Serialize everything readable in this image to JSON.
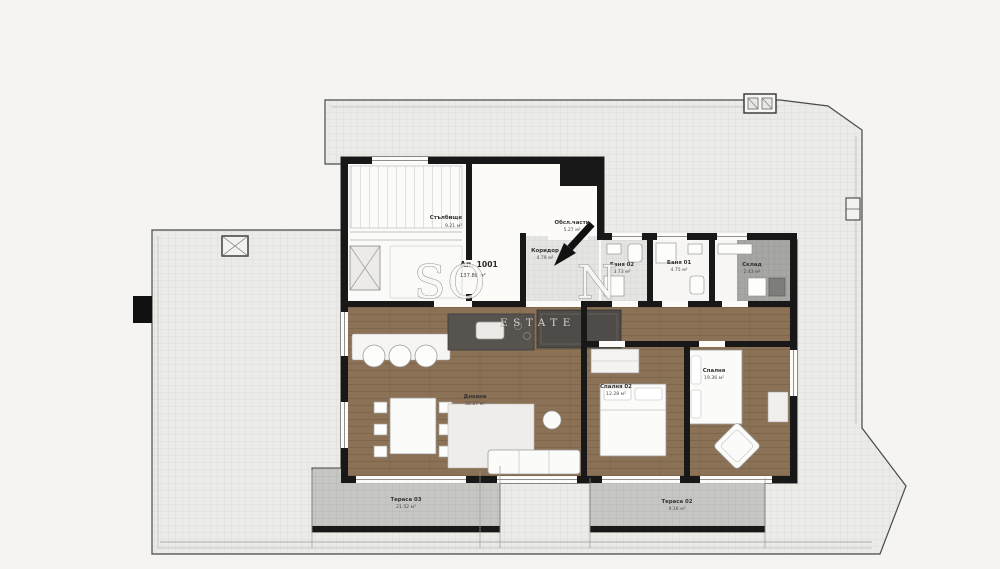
{
  "watermark": {
    "left_letters": "SO",
    "right_letter": "N",
    "line2": "ESTATE"
  },
  "apartment": {
    "number": "Ап. 1001",
    "area": "137.88 м²"
  },
  "rooms": [
    {
      "id": "stairs",
      "label": "Стълбище",
      "area": "9.21 м²"
    },
    {
      "id": "service",
      "label": "Обсл.части",
      "area": "5.27 м²"
    },
    {
      "id": "corridor",
      "label": "Коридор",
      "area": "4.79 м²"
    },
    {
      "id": "bath-02",
      "label": "Баня 02",
      "area": "3.73 м²"
    },
    {
      "id": "bath-01",
      "label": "Баня 01",
      "area": "4.75 м²"
    },
    {
      "id": "storage",
      "label": "Склад",
      "area": "2.43 м²"
    },
    {
      "id": "living",
      "label": "Дневна",
      "area": "32.27 м²"
    },
    {
      "id": "bedroom-02",
      "label": "Спалня 02",
      "area": "12.28 м²"
    },
    {
      "id": "bedroom-01",
      "label": "Спалня",
      "area": "19.36 м²"
    },
    {
      "id": "terrace-03",
      "label": "Тераса 03",
      "area": "21.52 м²"
    },
    {
      "id": "terrace-02",
      "label": "Тераса 02",
      "area": "9.16 м²"
    }
  ],
  "colors": {
    "background": "#f5f4f2",
    "wall": "#181818",
    "wood_floor": "#8b7156",
    "roof_hatch": "#ebebe8",
    "terrace_fill": "#c6c6c3",
    "watermark_text": "#faf9f7"
  }
}
